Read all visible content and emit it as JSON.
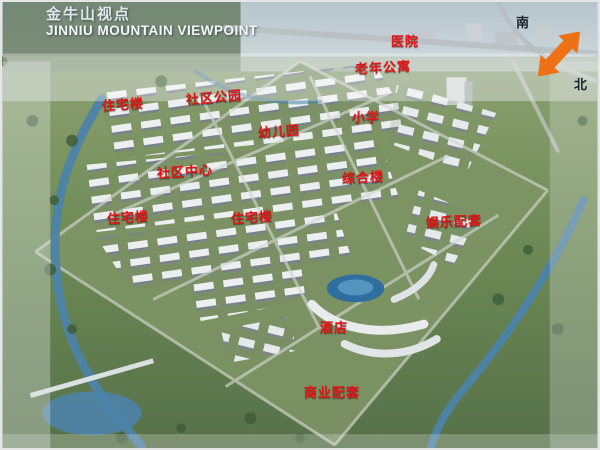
{
  "header": {
    "title_cn": "金牛山视点",
    "title_en": "JINNIU MOUNTAIN VIEWPOINT"
  },
  "compass": {
    "south": "南",
    "north": "北"
  },
  "labels": {
    "hospital": "医院",
    "senior_apartments": "老年公寓",
    "residential_1": "住宅楼",
    "community_park": "社区公园",
    "kindergarten": "幼儿园",
    "primary_school": "小学",
    "community_center": "社区中心",
    "complex_building": "综合楼",
    "residential_2": "住宅楼",
    "residential_3": "住宅楼",
    "entertainment_facilities": "娱乐配套",
    "hotel": "酒店",
    "commercial_facilities": "商业配套"
  },
  "colors": {
    "label_red": "#e21414",
    "compass_orange": "#ee7115",
    "water_blue": "#4d83a8",
    "site_green": "#6d8a55"
  }
}
